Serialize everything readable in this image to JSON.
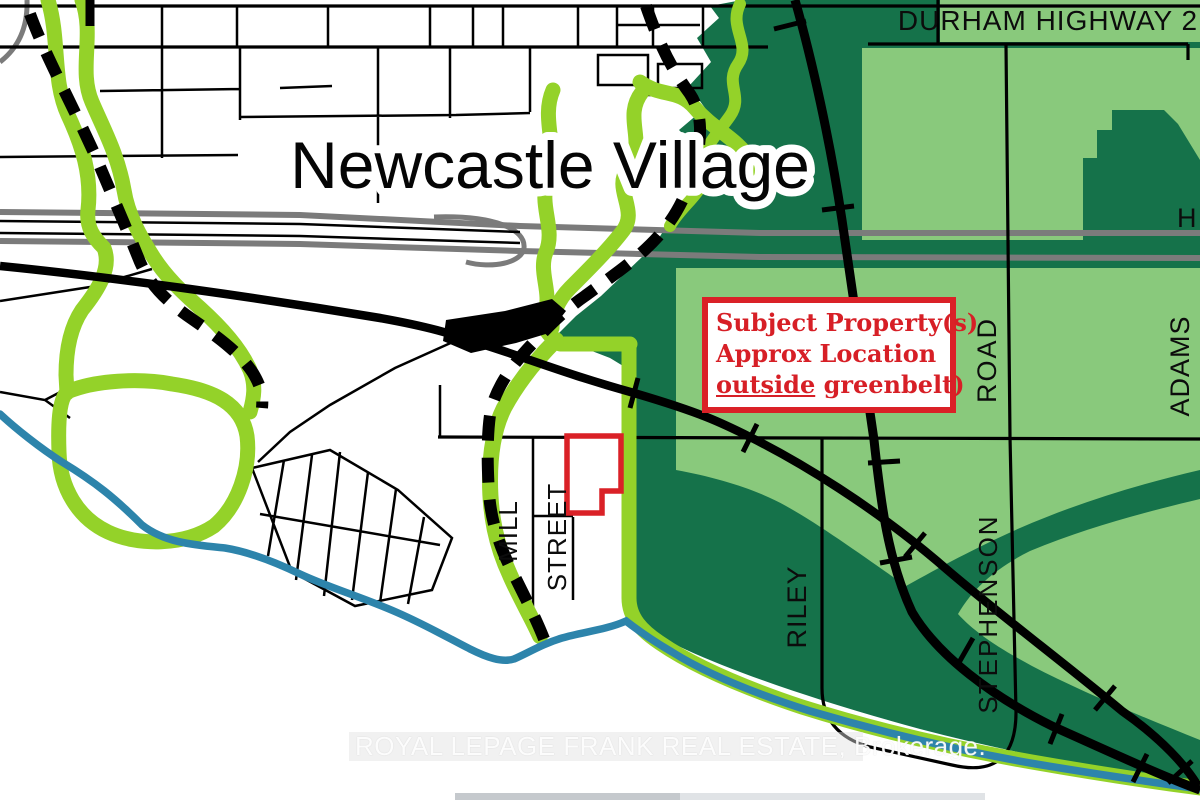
{
  "map": {
    "title": "Newcastle Village",
    "highway_label": "DURHAM HIGHWAY 2",
    "partial_label": "H",
    "road_labels": {
      "mill": "MILL",
      "street": "STREET",
      "riley": "RILEY",
      "road": "ROAD",
      "stephenson": "STEPHENSON",
      "adams": "ADAMS"
    },
    "annotation": {
      "line1": "Subject Property(s)",
      "line2": "Approx Location",
      "line3_underlined": "outside",
      "line3_rest": " greenbelt)"
    },
    "watermark": "ROYAL LEPAGE FRANK REAL ESTATE, Brokerage.",
    "colors": {
      "greenbelt_dark": "#15724a",
      "greenbelt_light": "#89c97c",
      "corridor_green": "#94d229",
      "water_blue": "#2d84ab",
      "annotation_red": "#da2127",
      "highway_gray": "#7b7b7b",
      "road_black": "#000000"
    }
  }
}
